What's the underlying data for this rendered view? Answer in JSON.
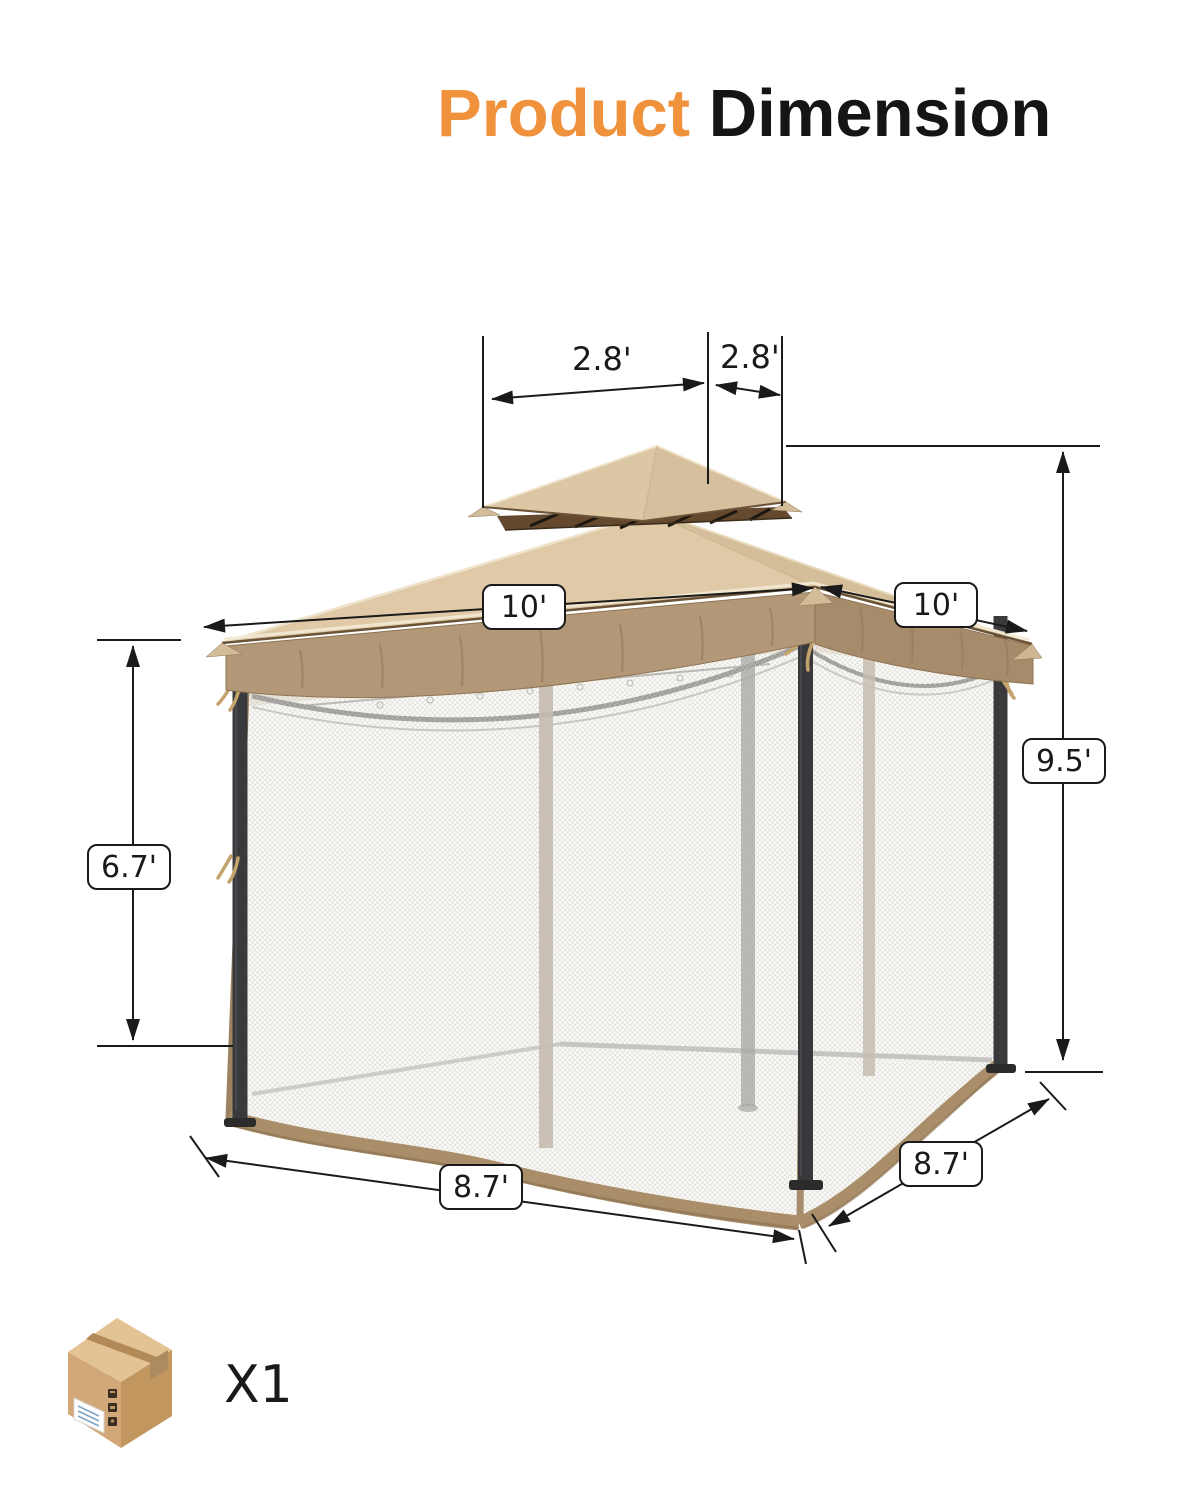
{
  "title": {
    "accent": "Product",
    "rest": "Dimension"
  },
  "dimensions": {
    "canopy_top_left": "2.8'",
    "canopy_top_right": "2.8'",
    "roof_left": "10'",
    "roof_right": "10'",
    "post_height": "6.7'",
    "total_height": "9.5'",
    "base_front": "8.7'",
    "base_side": "8.7'"
  },
  "package": {
    "quantity": "X1"
  },
  "icons": {
    "package": "package-box-icon"
  },
  "colors": {
    "accent_orange": "#F0913C",
    "text_black": "#151515",
    "canopy_tan": "#DFC9A7",
    "canopy_tan_dark": "#D4BD99",
    "valance_brown": "#B29877",
    "trim_brown": "#A98E69",
    "frame_dark": "#3A3A3C",
    "dimension_line": "#1a1a1a"
  }
}
